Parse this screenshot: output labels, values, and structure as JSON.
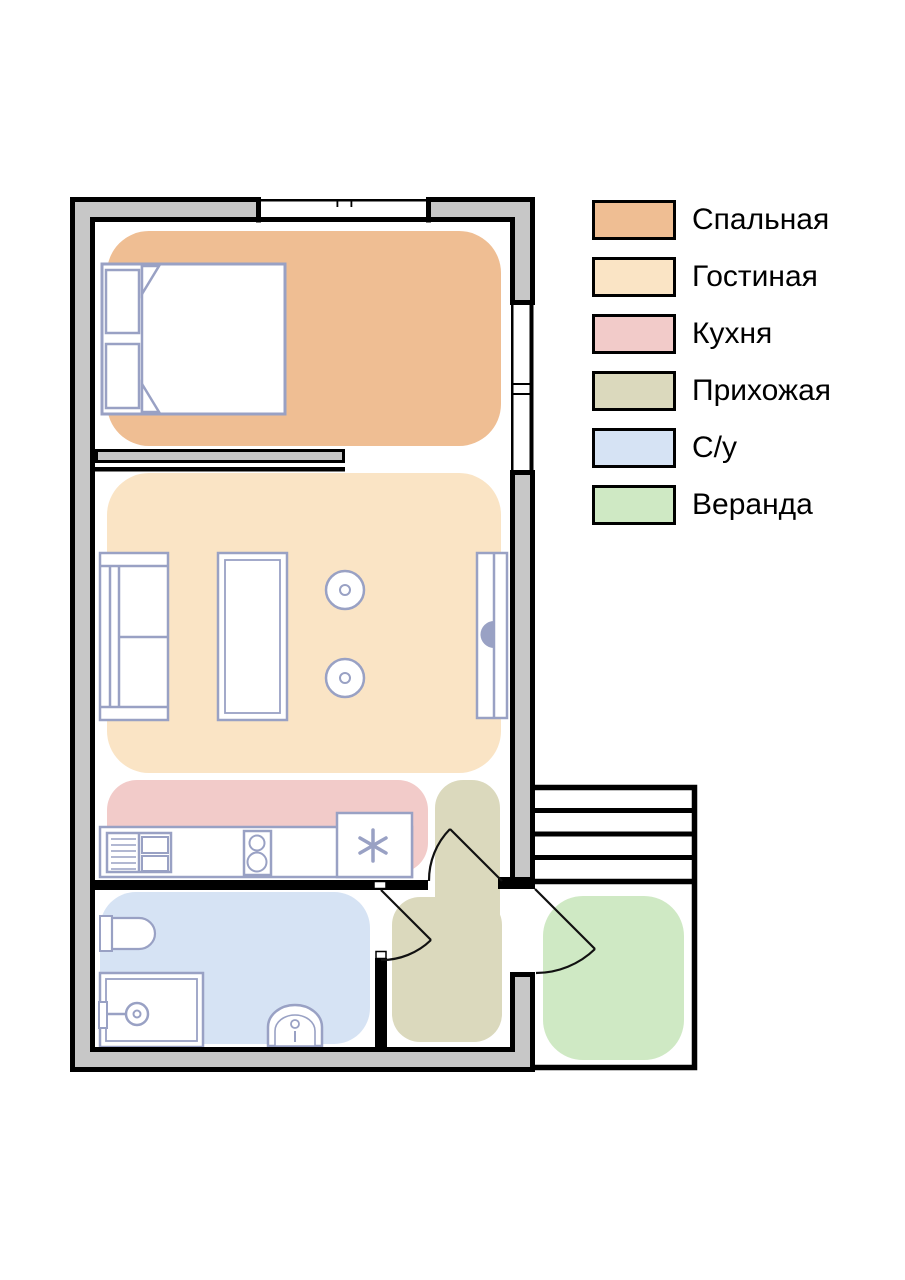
{
  "legend": {
    "swatch_border": "#000000",
    "items": [
      {
        "label": "Спальная",
        "color": "#efbe93"
      },
      {
        "label": "Гостиная",
        "color": "#fae4c5"
      },
      {
        "label": "Кухня",
        "color": "#f2cbc9"
      },
      {
        "label": "Прихожая",
        "color": "#dbd9bd"
      },
      {
        "label": "С/у",
        "color": "#d6e3f4"
      },
      {
        "label": "Веранда",
        "color": "#cfe9c4"
      }
    ]
  },
  "plan": {
    "wall_fill": "#c7c7c7",
    "outline": "#000000",
    "furniture_stroke": "#99a1c4",
    "background": "#ffffff"
  }
}
